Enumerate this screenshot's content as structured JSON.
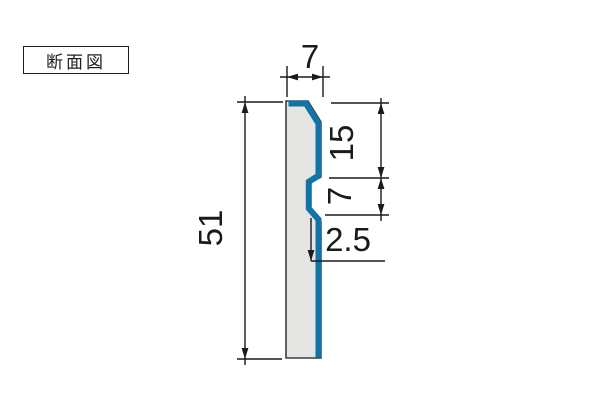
{
  "label_box": {
    "text": "断面図"
  },
  "drawing": {
    "type": "cross_section_profile",
    "dimensions": {
      "top_width": {
        "value": "7"
      },
      "overall_height": {
        "value": "51"
      },
      "top_to_notch": {
        "value": "15"
      },
      "notch_height": {
        "value": "7"
      },
      "notch_depth": {
        "value": "2.5"
      }
    },
    "colors": {
      "accent_blue": "#1173a6",
      "fill_gray": "#e5e6e3",
      "line_black": "#1a1a1a"
    }
  }
}
